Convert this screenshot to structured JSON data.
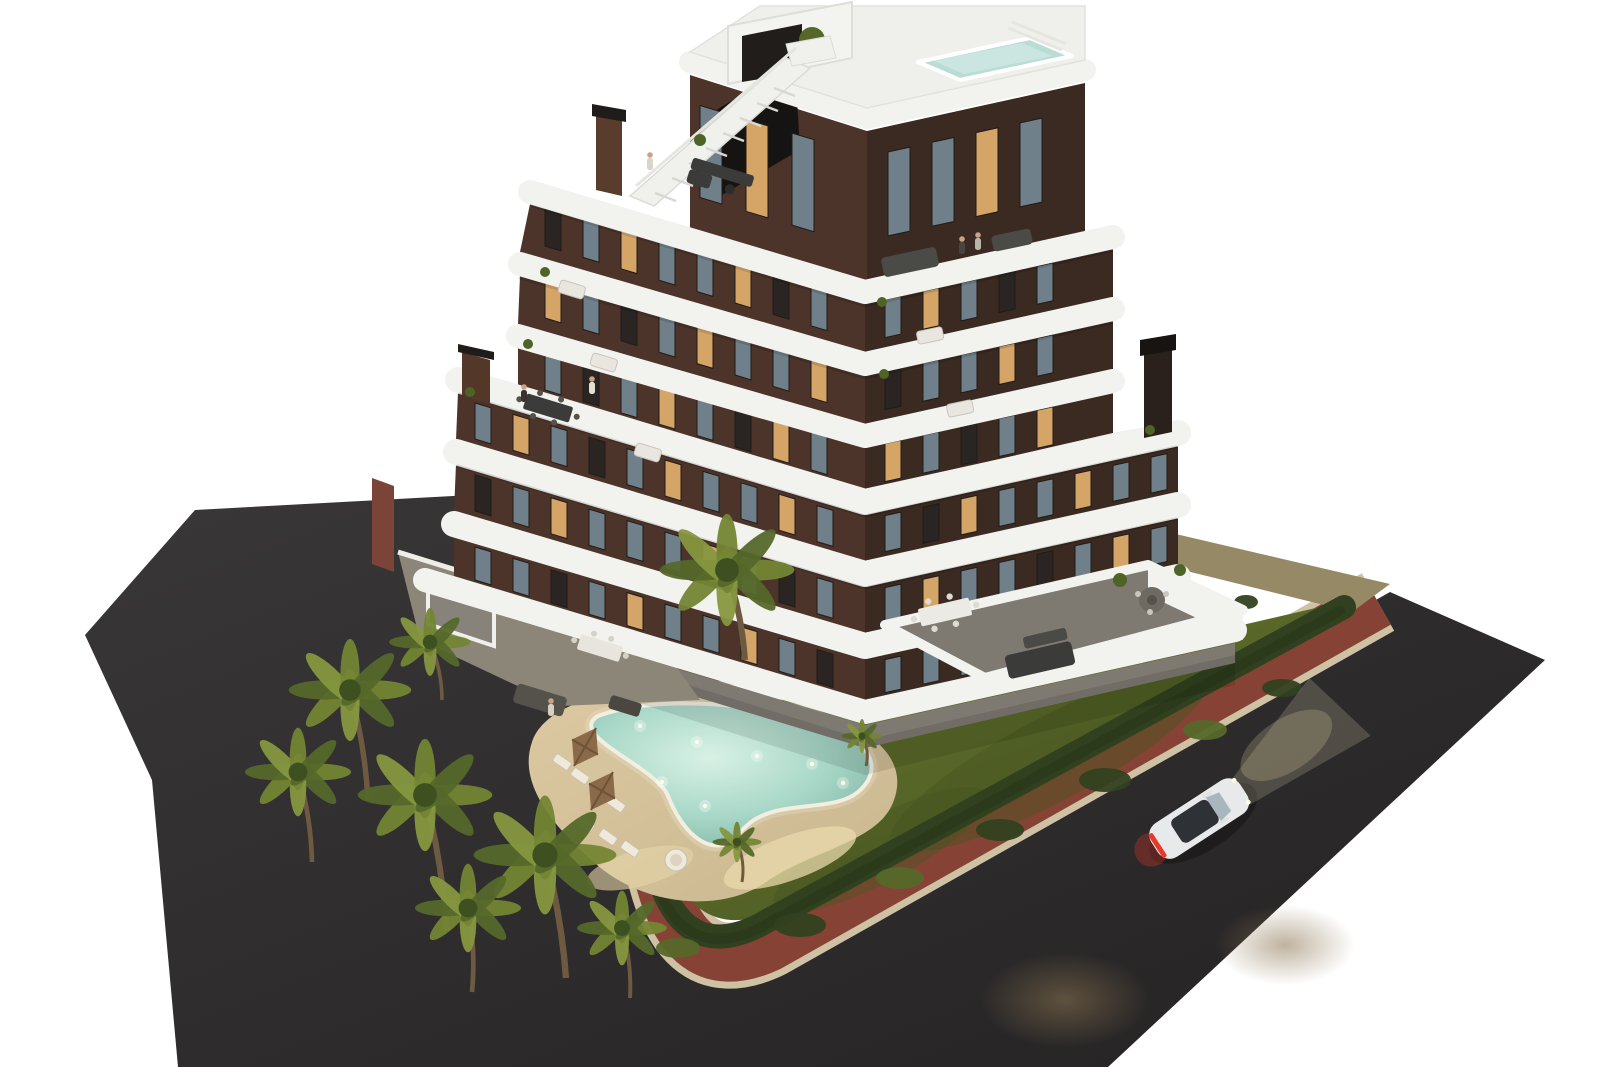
{
  "meta": {
    "type": "3d-architectural-exterior-render",
    "view": "aerial-corner-dusk",
    "subject": "modern-apartment-building-with-pool-garden-and-street-corner",
    "floors_visible": 7,
    "cars_visible": 1
  },
  "palette": {
    "background": "#ffffff",
    "road_light": "#3a3738",
    "road_dark": "#242223",
    "curb": "#cfc2a4",
    "sidewalk": "#8f4739",
    "dirt": "#968a66",
    "grass_light": "#6a7830",
    "grass_mid": "#556427",
    "grass_dark": "#475420",
    "hedge": "#314120",
    "hedge_dark": "#263516",
    "sand_light": "#dcc9a2",
    "sand_dark": "#c9b78f",
    "pool_light": "#d8f1e5",
    "pool_mid": "#a9d8c8",
    "pool_deep": "#7fb2a2",
    "pool_rim": "#f2efe2",
    "roof_pool": "#b9ddd5",
    "band": "#f2f2ef",
    "floor": "#e9e8e4",
    "white_wall": "#f2f2ee",
    "facade_left": "#4c342a",
    "facade_right": "#3a2a21",
    "glass": "#70808a",
    "window_lit": "#d4a567",
    "window_dark": "#2a2522",
    "trunk": "#6d5a41",
    "palm_a": "#748534",
    "palm_b": "#55682a",
    "palm_c": "#86973f",
    "palm_core": "#3e501f",
    "concrete": "#8c8678",
    "brick_wall": "#7a4438",
    "terrace_floor": "#7e7a72",
    "furniture_dark": "#3b3b39",
    "furniture_light": "#e9e6df",
    "umbrella": "#8a6a48",
    "umbrella_dark": "#6e5338",
    "car_body": "#e7e9eb",
    "car_glass": "#2e3237",
    "taillight": "#e8392c",
    "headlight_beam": "#f7ecc8",
    "skin": "#caa386"
  },
  "building": {
    "corner_x": 865,
    "left_slope": 0.3,
    "right_slope": 0.22,
    "window_w": 16,
    "window_rows": [
      {
        "side": "L",
        "xs": 545,
        "dx": 38,
        "n": 8,
        "y0": 304,
        "h": 38,
        "lit": [
          2,
          5
        ],
        "dark": [
          0,
          6
        ]
      },
      {
        "side": "L",
        "xs": 545,
        "dx": 38,
        "n": 8,
        "y0": 376,
        "h": 38,
        "lit": [
          0,
          4,
          7
        ],
        "dark": [
          2
        ]
      },
      {
        "side": "L",
        "xs": 545,
        "dx": 38,
        "n": 8,
        "y0": 448,
        "h": 38,
        "lit": [
          3,
          6
        ],
        "dark": [
          1,
          5
        ]
      },
      {
        "side": "L",
        "xs": 475,
        "dx": 38,
        "n": 10,
        "y0": 520,
        "h": 36,
        "lit": [
          1,
          5,
          8
        ],
        "dark": [
          3
        ]
      },
      {
        "side": "L",
        "xs": 475,
        "dx": 38,
        "n": 10,
        "y0": 592,
        "h": 36,
        "lit": [
          2,
          6
        ],
        "dark": [
          0,
          8
        ]
      },
      {
        "side": "L",
        "xs": 475,
        "dx": 38,
        "n": 10,
        "y0": 664,
        "h": 33,
        "lit": [
          4,
          7
        ],
        "dark": [
          2,
          9
        ]
      },
      {
        "side": "R",
        "xs": 885,
        "dx": 38,
        "n": 5,
        "y0": 304,
        "h": 38,
        "lit": [
          1
        ],
        "dark": [
          3
        ]
      },
      {
        "side": "R",
        "xs": 885,
        "dx": 38,
        "n": 5,
        "y0": 376,
        "h": 38,
        "lit": [
          3
        ],
        "dark": [
          0
        ]
      },
      {
        "side": "R",
        "xs": 885,
        "dx": 38,
        "n": 5,
        "y0": 448,
        "h": 38,
        "lit": [
          0,
          4
        ],
        "dark": [
          2
        ]
      },
      {
        "side": "R",
        "xs": 885,
        "dx": 38,
        "n": 8,
        "y0": 520,
        "h": 36,
        "lit": [
          2,
          5
        ],
        "dark": [
          1
        ]
      },
      {
        "side": "R",
        "xs": 885,
        "dx": 38,
        "n": 8,
        "y0": 592,
        "h": 36,
        "lit": [
          1,
          6
        ],
        "dark": [
          4
        ]
      },
      {
        "side": "R",
        "xs": 885,
        "dx": 38,
        "n": 8,
        "y0": 664,
        "h": 33,
        "lit": [
          3
        ],
        "dark": [
          5,
          7
        ]
      },
      {
        "side": "L",
        "xs": 700,
        "dx": 46,
        "n": 3,
        "y0": 155,
        "h": 92,
        "w": 22,
        "lit": [
          1
        ],
        "dark": []
      },
      {
        "side": "R",
        "xs": 888,
        "dx": 44,
        "n": 4,
        "y0": 157,
        "h": 84,
        "w": 22,
        "lit": [
          2
        ],
        "dark": []
      }
    ]
  },
  "garden": {
    "palms": [
      {
        "x": 350,
        "y": 690,
        "r": 60,
        "base": [
          368,
          800
        ]
      },
      {
        "x": 298,
        "y": 772,
        "r": 52,
        "base": [
          312,
          862
        ]
      },
      {
        "x": 425,
        "y": 795,
        "r": 66,
        "base": [
          447,
          930
        ]
      },
      {
        "x": 545,
        "y": 855,
        "r": 70,
        "base": [
          566,
          978
        ]
      },
      {
        "x": 468,
        "y": 908,
        "r": 52,
        "base": [
          472,
          992
        ]
      },
      {
        "x": 622,
        "y": 928,
        "r": 44,
        "base": [
          630,
          998
        ]
      },
      {
        "x": 430,
        "y": 642,
        "r": 40,
        "base": [
          442,
          700
        ]
      },
      {
        "x": 727,
        "y": 570,
        "r": 66,
        "base": [
          745,
          660
        ]
      },
      {
        "x": 737,
        "y": 842,
        "r": 24,
        "base": [
          742,
          882
        ]
      },
      {
        "x": 862,
        "y": 736,
        "r": 20,
        "base": [
          866,
          766
        ]
      }
    ],
    "bushes": [
      {
        "x": 640,
        "y": 602,
        "rx": 26,
        "ry": 12
      },
      {
        "x": 602,
        "y": 576,
        "rx": 20,
        "ry": 10
      },
      {
        "x": 800,
        "y": 925,
        "rx": 26,
        "ry": 12
      },
      {
        "x": 900,
        "y": 878,
        "rx": 24,
        "ry": 11
      },
      {
        "x": 1000,
        "y": 830,
        "rx": 24,
        "ry": 11
      },
      {
        "x": 1105,
        "y": 780,
        "rx": 26,
        "ry": 12
      },
      {
        "x": 1205,
        "y": 730,
        "rx": 22,
        "ry": 10
      },
      {
        "x": 1282,
        "y": 688,
        "rx": 20,
        "ry": 9
      },
      {
        "x": 1150,
        "y": 644,
        "rx": 16,
        "ry": 9
      },
      {
        "x": 1196,
        "y": 622,
        "rx": 14,
        "ry": 8
      },
      {
        "x": 1246,
        "y": 602,
        "rx": 12,
        "ry": 7
      },
      {
        "x": 434,
        "y": 588,
        "rx": 18,
        "ry": 9
      },
      {
        "x": 678,
        "y": 948,
        "rx": 22,
        "ry": 10
      },
      {
        "x": 560,
        "y": 700,
        "rx": 18,
        "ry": 9
      }
    ],
    "pool_lights": [
      {
        "x": 640,
        "y": 726
      },
      {
        "x": 697,
        "y": 742
      },
      {
        "x": 757,
        "y": 756
      },
      {
        "x": 812,
        "y": 764
      },
      {
        "x": 843,
        "y": 783
      },
      {
        "x": 705,
        "y": 806
      },
      {
        "x": 662,
        "y": 782
      }
    ],
    "loungers": [
      [
        562,
        762
      ],
      [
        580,
        776
      ],
      [
        598,
        790
      ],
      [
        616,
        804
      ],
      [
        585,
        824
      ],
      [
        608,
        837
      ],
      [
        630,
        849
      ]
    ],
    "umbrellas": [
      [
        585,
        747
      ],
      [
        602,
        791
      ]
    ],
    "people": [
      {
        "x": 650,
        "y": 168,
        "c": "#d9d4c8"
      },
      {
        "x": 962,
        "y": 252,
        "c": "#4a4440"
      },
      {
        "x": 978,
        "y": 248,
        "c": "#b9b4a8"
      },
      {
        "x": 551,
        "y": 714,
        "c": "#d9cfc0"
      },
      {
        "x": 524,
        "y": 400,
        "c": "#3a3430"
      },
      {
        "x": 592,
        "y": 392,
        "c": "#e4e0d4"
      }
    ]
  }
}
